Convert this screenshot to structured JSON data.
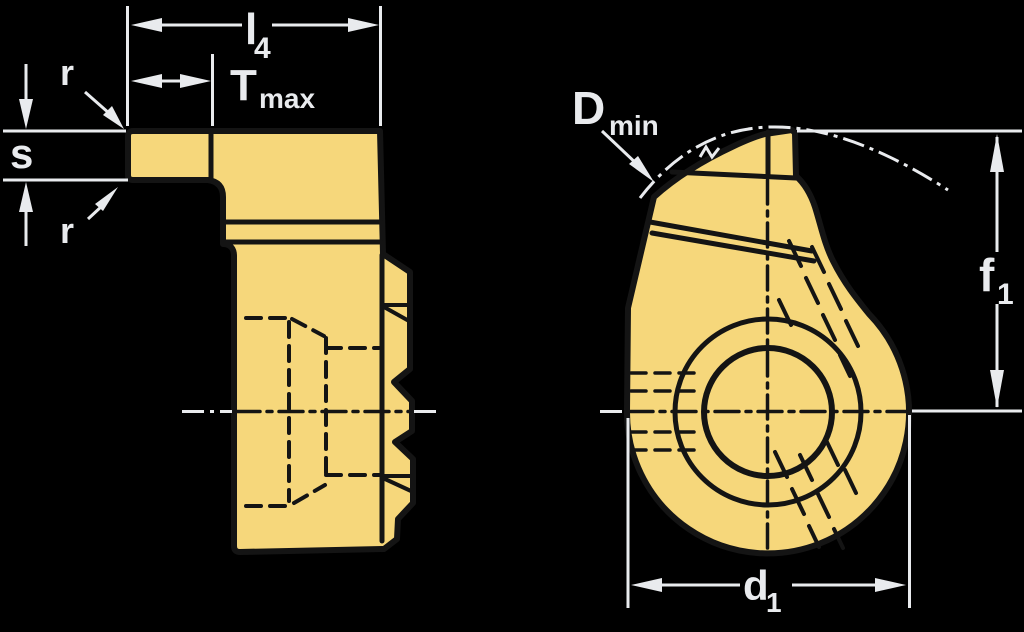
{
  "figure": {
    "type": "technical-drawing",
    "description": "Grooving insert engineering drawing: side profile view (left) and round front view with screw hole (right), with dimension callouts",
    "background": "#000000"
  },
  "colors": {
    "insert_fill": "#F6D77B",
    "insert_linework": "#141414",
    "dimension_color": "#E9EBEE",
    "hole_fill": "#FFFFFF"
  },
  "labels": {
    "l4": {
      "base": "l",
      "sub": "4"
    },
    "tmax": {
      "base": "T",
      "sub": "max"
    },
    "r_top": "r",
    "s": "s",
    "r_bottom": "r",
    "dmin": {
      "base": "D",
      "sub": "min"
    },
    "f1": {
      "base": "f",
      "sub": "1"
    },
    "d1": {
      "base": "d",
      "sub": "1"
    }
  }
}
